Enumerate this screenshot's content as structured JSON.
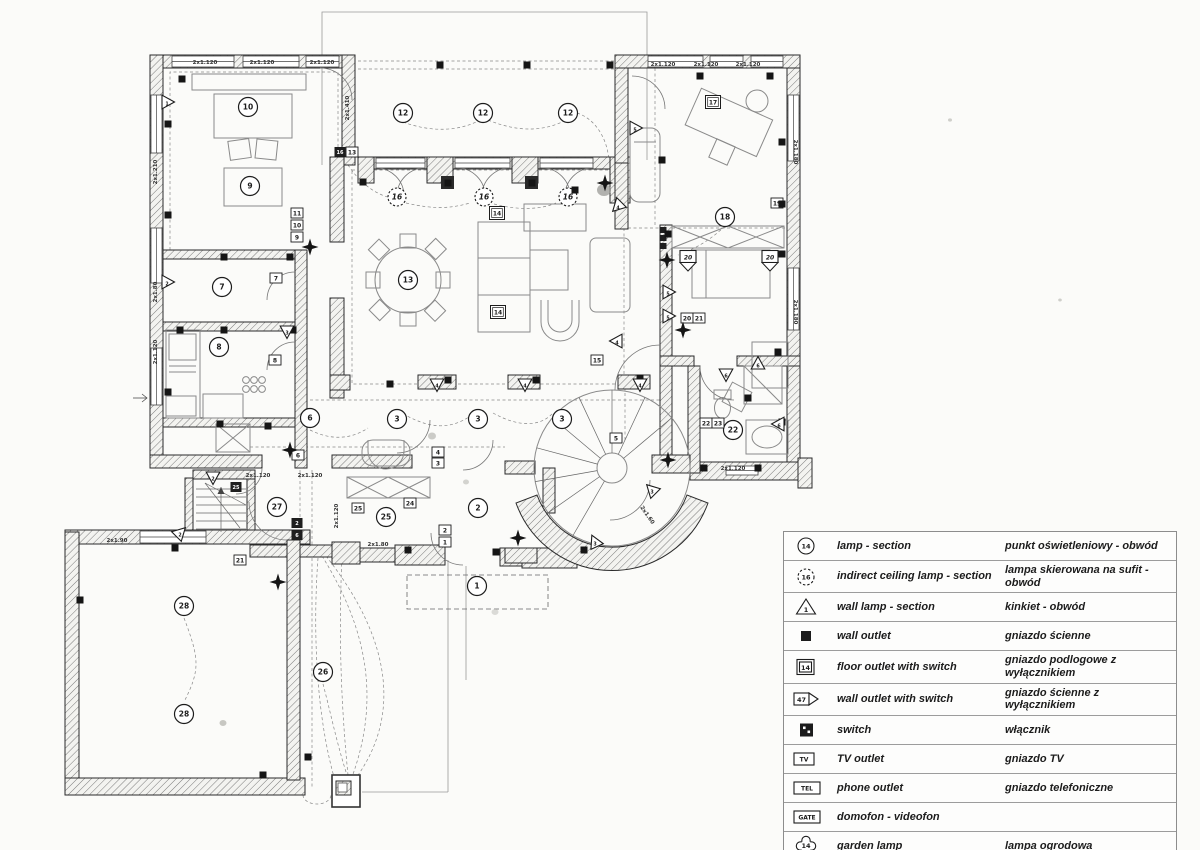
{
  "plan": {
    "room_circles": [
      {
        "n": "10",
        "x": 248,
        "y": 107
      },
      {
        "n": "9",
        "x": 250,
        "y": 186
      },
      {
        "n": "7",
        "x": 222,
        "y": 287
      },
      {
        "n": "8",
        "x": 219,
        "y": 347
      },
      {
        "n": "6",
        "x": 310,
        "y": 418
      },
      {
        "n": "12",
        "x": 403,
        "y": 113
      },
      {
        "n": "12",
        "x": 483,
        "y": 113
      },
      {
        "n": "12",
        "x": 568,
        "y": 113
      },
      {
        "n": "13",
        "x": 408,
        "y": 280
      },
      {
        "n": "18",
        "x": 725,
        "y": 217
      },
      {
        "n": "22",
        "x": 733,
        "y": 430
      },
      {
        "n": "3",
        "x": 397,
        "y": 419
      },
      {
        "n": "3",
        "x": 478,
        "y": 419
      },
      {
        "n": "3",
        "x": 562,
        "y": 419
      },
      {
        "n": "27",
        "x": 277,
        "y": 507
      },
      {
        "n": "25",
        "x": 386,
        "y": 517
      },
      {
        "n": "2",
        "x": 478,
        "y": 508
      },
      {
        "n": "1",
        "x": 477,
        "y": 586
      },
      {
        "n": "28",
        "x": 184,
        "y": 606
      },
      {
        "n": "28",
        "x": 184,
        "y": 714
      },
      {
        "n": "26",
        "x": 323,
        "y": 672
      }
    ],
    "indirect_lamps": [
      {
        "n": "16",
        "x": 397,
        "y": 197
      },
      {
        "n": "16",
        "x": 484,
        "y": 197
      },
      {
        "n": "16",
        "x": 568,
        "y": 197
      }
    ],
    "boxed_labels": [
      {
        "t": "17",
        "x": 713,
        "y": 102,
        "s": "double"
      },
      {
        "t": "14",
        "x": 497,
        "y": 213,
        "s": "double"
      },
      {
        "t": "14",
        "x": 498,
        "y": 312,
        "s": "double"
      },
      {
        "t": "11",
        "x": 297,
        "y": 213
      },
      {
        "t": "10",
        "x": 297,
        "y": 225
      },
      {
        "t": "9",
        "x": 297,
        "y": 237
      },
      {
        "t": "16",
        "x": 340,
        "y": 152,
        "s": "dark"
      },
      {
        "t": "13",
        "x": 352,
        "y": 152
      },
      {
        "t": "7",
        "x": 276,
        "y": 278
      },
      {
        "t": "8",
        "x": 275,
        "y": 360
      },
      {
        "t": "4",
        "x": 438,
        "y": 452
      },
      {
        "t": "3",
        "x": 438,
        "y": 463
      },
      {
        "t": "2",
        "x": 445,
        "y": 530
      },
      {
        "t": "1",
        "x": 445,
        "y": 542
      },
      {
        "t": "2",
        "x": 297,
        "y": 523,
        "s": "dark"
      },
      {
        "t": "6",
        "x": 297,
        "y": 535,
        "s": "dark"
      },
      {
        "t": "25",
        "x": 358,
        "y": 508
      },
      {
        "t": "24",
        "x": 410,
        "y": 503
      },
      {
        "t": "25",
        "x": 236,
        "y": 487,
        "s": "dark"
      },
      {
        "t": "6",
        "x": 298,
        "y": 455
      },
      {
        "t": "5",
        "x": 616,
        "y": 438
      },
      {
        "t": "22",
        "x": 706,
        "y": 423
      },
      {
        "t": "23",
        "x": 718,
        "y": 423
      },
      {
        "t": "20",
        "x": 687,
        "y": 318
      },
      {
        "t": "21",
        "x": 699,
        "y": 318
      },
      {
        "t": "19",
        "x": 777,
        "y": 203
      },
      {
        "t": "15",
        "x": 597,
        "y": 360
      },
      {
        "t": "21",
        "x": 240,
        "y": 560
      },
      {
        "t": "",
        "x": 663,
        "y": 230,
        "s": "tiny"
      },
      {
        "t": "",
        "x": 663,
        "y": 238,
        "s": "tiny"
      },
      {
        "t": "",
        "x": 663,
        "y": 246,
        "s": "tiny"
      },
      {
        "t": "20",
        "x": 688,
        "y": 257,
        "s": "pennant"
      },
      {
        "t": "20",
        "x": 770,
        "y": 257,
        "s": "pennant"
      }
    ],
    "dim_labels": [
      {
        "t": "2x1.120",
        "x": 205,
        "y": 64,
        "r": 0
      },
      {
        "t": "2x1.120",
        "x": 262,
        "y": 64,
        "r": 0
      },
      {
        "t": "2x1.120",
        "x": 322,
        "y": 64,
        "r": 0
      },
      {
        "t": "2x1.120",
        "x": 663,
        "y": 66,
        "r": 0
      },
      {
        "t": "2x1.120",
        "x": 706,
        "y": 66,
        "r": 0
      },
      {
        "t": "2x1.120",
        "x": 748,
        "y": 66,
        "r": 0
      },
      {
        "t": "2x1.410",
        "x": 349,
        "y": 108,
        "r": -90
      },
      {
        "t": "2x1.210",
        "x": 157,
        "y": 172,
        "r": -90
      },
      {
        "t": "2x1.80",
        "x": 157,
        "y": 292,
        "r": -90
      },
      {
        "t": "2x1.120",
        "x": 157,
        "y": 352,
        "r": -90
      },
      {
        "t": "2x1.180",
        "x": 794,
        "y": 152,
        "r": 90
      },
      {
        "t": "2x1.180",
        "x": 794,
        "y": 312,
        "r": 90
      },
      {
        "t": "2x1.120",
        "x": 258,
        "y": 477,
        "r": 0
      },
      {
        "t": "2x1.120",
        "x": 310,
        "y": 477,
        "r": 0
      },
      {
        "t": "2x1.120",
        "x": 338,
        "y": 516,
        "r": -90
      },
      {
        "t": "2x1.80",
        "x": 378,
        "y": 546,
        "r": 0
      },
      {
        "t": "2x1.120",
        "x": 733,
        "y": 470,
        "r": 0
      },
      {
        "t": "2x1.90",
        "x": 117,
        "y": 542,
        "r": 0
      },
      {
        "t": "2x1.60",
        "x": 646,
        "y": 516,
        "r": 55
      }
    ],
    "wall_outlets": [
      [
        182,
        79
      ],
      [
        168,
        124
      ],
      [
        168,
        215
      ],
      [
        224,
        257
      ],
      [
        290,
        257
      ],
      [
        180,
        330
      ],
      [
        224,
        330
      ],
      [
        293,
        330
      ],
      [
        168,
        392
      ],
      [
        220,
        424
      ],
      [
        268,
        426
      ],
      [
        440,
        65
      ],
      [
        527,
        65
      ],
      [
        610,
        65
      ],
      [
        363,
        182
      ],
      [
        448,
        183
      ],
      [
        532,
        183
      ],
      [
        575,
        190
      ],
      [
        390,
        384
      ],
      [
        448,
        380
      ],
      [
        536,
        380
      ],
      [
        640,
        378
      ],
      [
        700,
        76
      ],
      [
        770,
        76
      ],
      [
        782,
        142
      ],
      [
        782,
        204
      ],
      [
        668,
        234
      ],
      [
        782,
        254
      ],
      [
        778,
        352
      ],
      [
        782,
        422
      ],
      [
        704,
        468
      ],
      [
        758,
        468
      ],
      [
        748,
        398
      ],
      [
        408,
        550
      ],
      [
        496,
        552
      ],
      [
        584,
        550
      ],
      [
        175,
        548
      ],
      [
        263,
        775
      ],
      [
        80,
        600
      ],
      [
        308,
        757
      ],
      [
        662,
        160
      ]
    ],
    "wall_lamps": [
      {
        "x": 167,
        "y": 102,
        "r": 90,
        "n": "1"
      },
      {
        "x": 167,
        "y": 282,
        "r": 90,
        "n": "2"
      },
      {
        "x": 287,
        "y": 331,
        "r": 180,
        "n": "3"
      },
      {
        "x": 437,
        "y": 384,
        "r": 180,
        "n": "4"
      },
      {
        "x": 525,
        "y": 384,
        "r": 180,
        "n": "4"
      },
      {
        "x": 640,
        "y": 384,
        "r": 180,
        "n": "4"
      },
      {
        "x": 618,
        "y": 206,
        "r": -135,
        "n": "4"
      },
      {
        "x": 617,
        "y": 341,
        "r": -90,
        "n": "4"
      },
      {
        "x": 635,
        "y": 128,
        "r": 90,
        "n": "5"
      },
      {
        "x": 668,
        "y": 292,
        "r": 90,
        "n": "5"
      },
      {
        "x": 668,
        "y": 316,
        "r": 90,
        "n": "5"
      },
      {
        "x": 758,
        "y": 364,
        "r": 0,
        "n": "6"
      },
      {
        "x": 726,
        "y": 374,
        "r": 180,
        "n": "6"
      },
      {
        "x": 779,
        "y": 424,
        "r": -90,
        "n": "6"
      },
      {
        "x": 652,
        "y": 490,
        "r": -45,
        "n": "3"
      },
      {
        "x": 595,
        "y": 542,
        "r": -25,
        "n": "3"
      },
      {
        "x": 213,
        "y": 477,
        "r": 180,
        "n": "2"
      },
      {
        "x": 180,
        "y": 533,
        "r": 45,
        "n": "2"
      }
    ],
    "vacuum_outlets": [
      [
        310,
        247
      ],
      [
        605,
        183
      ],
      [
        290,
        450
      ],
      [
        278,
        582
      ],
      [
        518,
        538
      ],
      [
        668,
        460
      ],
      [
        667,
        260
      ],
      [
        683,
        330
      ]
    ]
  },
  "legend": {
    "rows": [
      {
        "icon": "circle",
        "icon_label": "14",
        "en": "lamp - section",
        "pl": "punkt  oświetleniowy - obwód"
      },
      {
        "icon": "dashed-circle",
        "icon_label": "16",
        "en": "indirect ceiling lamp - section",
        "pl": "lampa skierowana na sufit - obwód"
      },
      {
        "icon": "triangle",
        "icon_label": "1",
        "en": "wall lamp - section",
        "pl": "kinkiet - obwód"
      },
      {
        "icon": "filled-square",
        "icon_label": "",
        "en": "wall outlet",
        "pl": "gniazdo ścienne"
      },
      {
        "icon": "double-box",
        "icon_label": "14",
        "en": "floor outlet with switch",
        "pl": "gniazdo podlogowe z wyłącznikiem"
      },
      {
        "icon": "pennant-box",
        "icon_label": "47",
        "en": "wall outlet with switch",
        "pl": "gniazdo ścienne z wyłącznikiem"
      },
      {
        "icon": "switch",
        "icon_label": "",
        "en": "switch",
        "pl": "włącznik"
      },
      {
        "icon": "box",
        "icon_label": "TV",
        "en": "TV  outlet",
        "pl": "gniazdo TV"
      },
      {
        "icon": "box",
        "icon_label": "TEL",
        "en": "phone  outlet",
        "pl": "gniazdo telefoniczne"
      },
      {
        "icon": "box",
        "icon_label": "GATE",
        "en": "domofon - videofon",
        "pl": ""
      },
      {
        "icon": "flower",
        "icon_label": "14",
        "en": "garden lamp",
        "pl": "lampa ogrodowa"
      },
      {
        "icon": "star",
        "icon_label": "",
        "en": "vaccum  outlet",
        "pl": "centralny odkurzacz"
      }
    ]
  },
  "colors": {
    "ink": "#1c1c1c",
    "paper": "#fbfbf9"
  }
}
